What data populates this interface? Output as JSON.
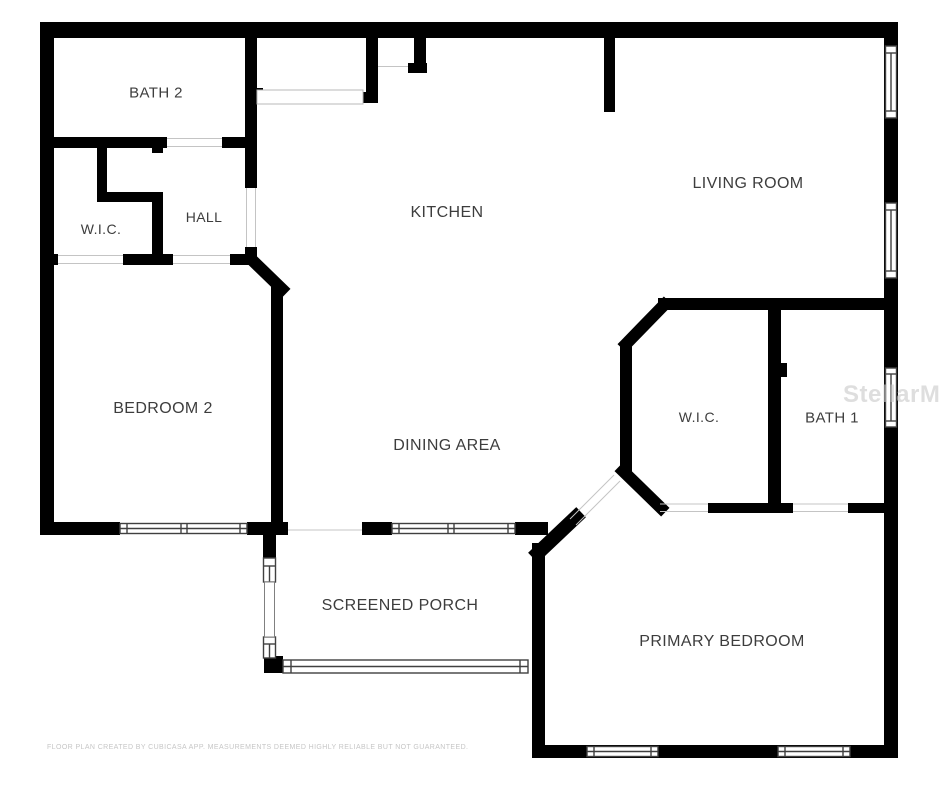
{
  "floorplan": {
    "rooms": {
      "bath2": {
        "label": "BATH 2"
      },
      "wic1": {
        "label": "W.I.C."
      },
      "hall": {
        "label": "HALL"
      },
      "kitchen": {
        "label": "KITCHEN"
      },
      "living": {
        "label": "LIVING ROOM"
      },
      "bedroom2": {
        "label": "BEDROOM 2"
      },
      "dining": {
        "label": "DINING AREA"
      },
      "wic2": {
        "label": "W.I.C."
      },
      "bath1": {
        "label": "BATH 1"
      },
      "porch": {
        "label": "SCREENED PORCH"
      },
      "primary": {
        "label": "PRIMARY BEDROOM"
      }
    },
    "watermark": "StellarMLS",
    "disclaimer": "FLOOR PLAN CREATED BY CUBICASA APP. MEASUREMENTS DEEMED HIGHLY RELIABLE BUT NOT GUARANTEED.",
    "colors": {
      "wall": "#000000",
      "background": "#ffffff",
      "label": "#3d3d3d",
      "watermark": "#c9c9c9",
      "disclaimer": "#c6c6c6"
    }
  }
}
